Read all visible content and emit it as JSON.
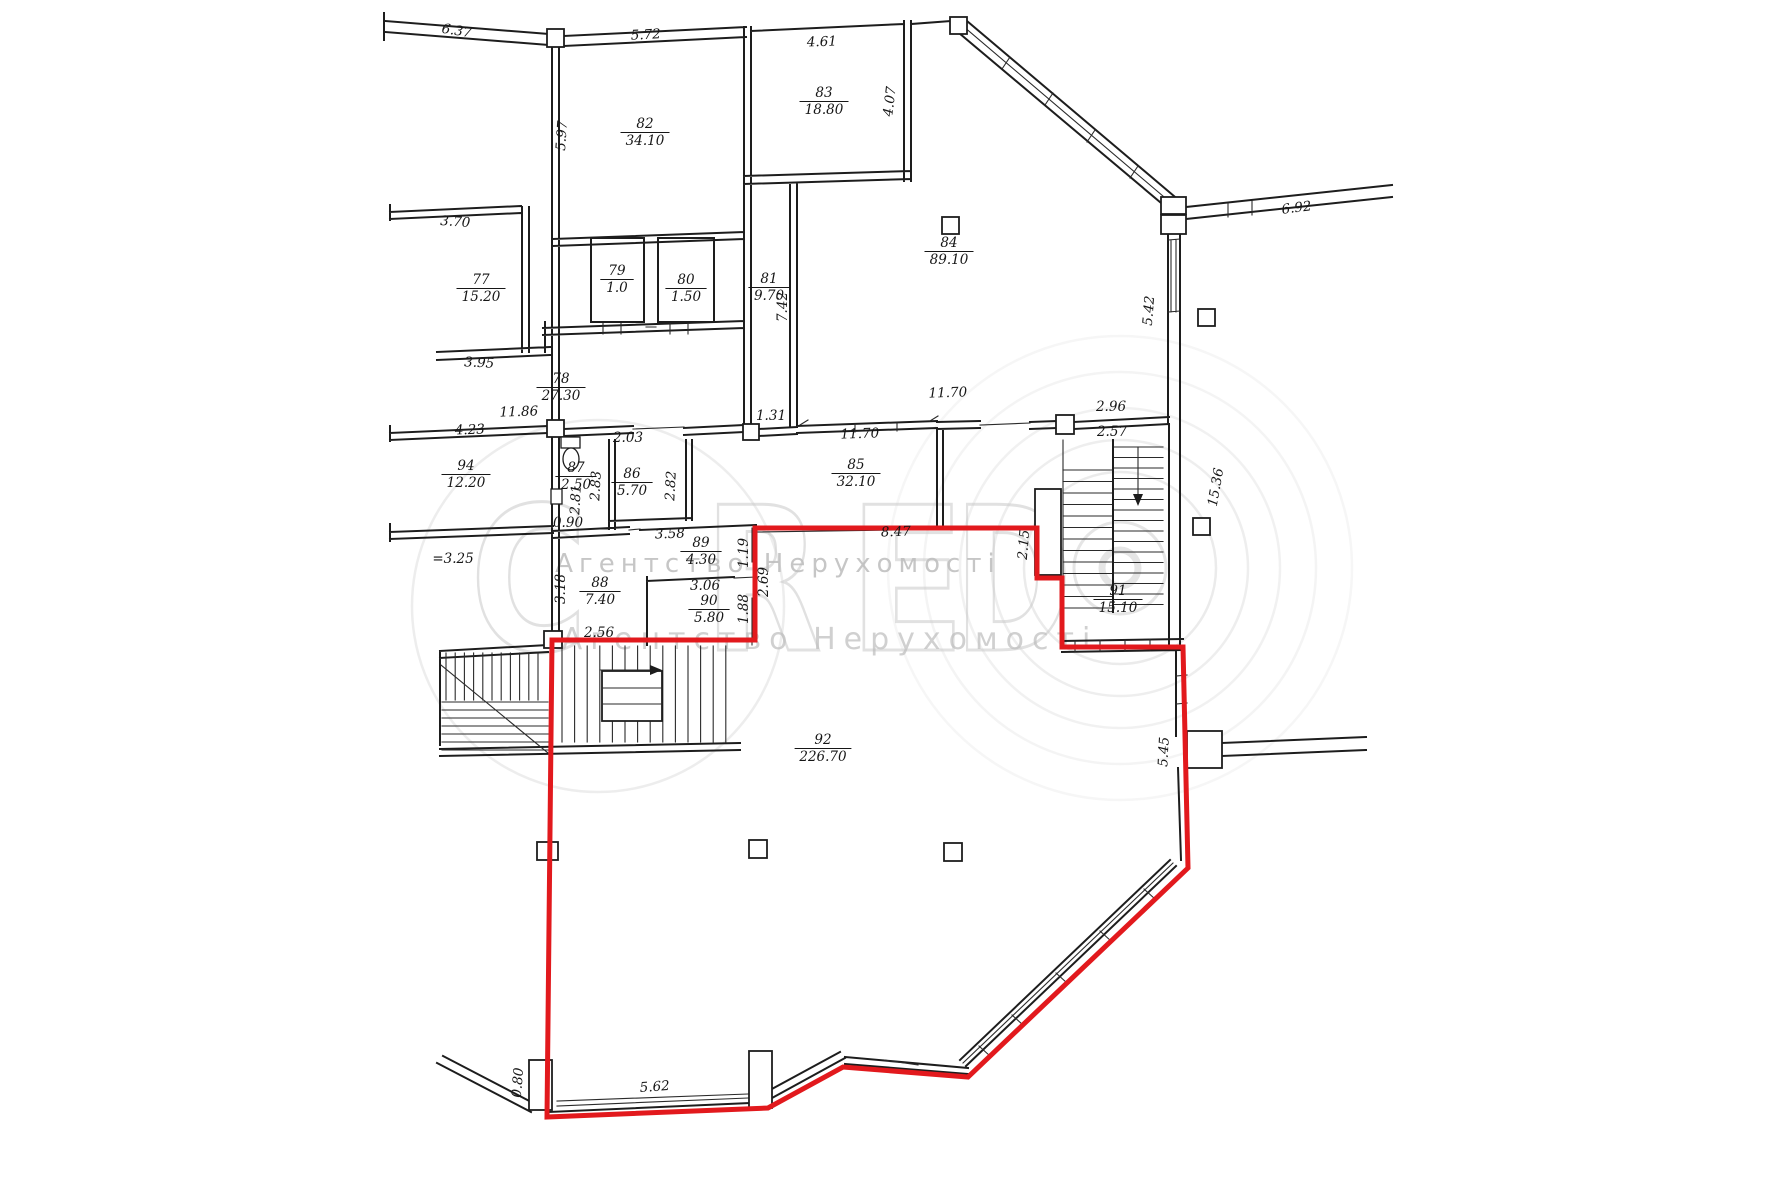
{
  "document": {
    "kind": "floor-plan-scan",
    "selected_unit_room": "92",
    "selected_unit_area": "226.70"
  },
  "colors": {
    "outline_red": "#e2191d",
    "wall_black": "#1d1d1d",
    "watermark_gray": "#c9c9c9",
    "paper": "#ffffff"
  },
  "watermark": {
    "brand": "CREDO",
    "letters": [
      {
        "ch": "C",
        "x": 470
      },
      {
        "ch": "R",
        "x": 704
      },
      {
        "ch": "E",
        "x": 848
      },
      {
        "ch": "D",
        "x": 954
      }
    ],
    "tagline1": "Агентство Нерухомості",
    "tagline2": "Агентство Нерухомості"
  },
  "rooms": [
    {
      "n": "77",
      "a": "15.20",
      "x": 481,
      "y": 284
    },
    {
      "n": "78",
      "a": "27.30",
      "x": 561,
      "y": 383
    },
    {
      "n": "79",
      "a": "1.0",
      "x": 617,
      "y": 275
    },
    {
      "n": "80",
      "a": "1.50",
      "x": 686,
      "y": 284
    },
    {
      "n": "81",
      "a": "9.70",
      "x": 769,
      "y": 283
    },
    {
      "n": "82",
      "a": "34.10",
      "x": 645,
      "y": 128
    },
    {
      "n": "83",
      "a": "18.80",
      "x": 824,
      "y": 97
    },
    {
      "n": "84",
      "a": "89.10",
      "x": 949,
      "y": 247
    },
    {
      "n": "85",
      "a": "32.10",
      "x": 856,
      "y": 469
    },
    {
      "n": "86",
      "a": "5.70",
      "x": 632,
      "y": 478
    },
    {
      "n": "87",
      "a": "2.50",
      "x": 576,
      "y": 472
    },
    {
      "n": "88",
      "a": "7.40",
      "x": 600,
      "y": 587
    },
    {
      "n": "89",
      "a": "4.30",
      "x": 701,
      "y": 547
    },
    {
      "n": "90",
      "a": "5.80",
      "x": 709,
      "y": 605
    },
    {
      "n": "91",
      "a": "15.10",
      "x": 1118,
      "y": 595
    },
    {
      "n": "92",
      "a": "226.70",
      "x": 823,
      "y": 744
    },
    {
      "n": "94",
      "a": "12.20",
      "x": 466,
      "y": 470
    }
  ],
  "dims": [
    {
      "t": "6.37",
      "x": 456,
      "y": 35,
      "r": 9
    },
    {
      "t": "5.72",
      "x": 646,
      "y": 39,
      "r": -3
    },
    {
      "t": "4.61",
      "x": 822,
      "y": 46,
      "r": -2
    },
    {
      "t": "5.97",
      "x": 566,
      "y": 136,
      "r": -86
    },
    {
      "t": "4.07",
      "x": 894,
      "y": 102,
      "r": -83
    },
    {
      "t": "3.70",
      "x": 455,
      "y": 226,
      "r": 4
    },
    {
      "t": "7.42",
      "x": 787,
      "y": 307,
      "r": -90
    },
    {
      "t": "6.92",
      "x": 1297,
      "y": 212,
      "r": -7
    },
    {
      "t": "5.42",
      "x": 1153,
      "y": 311,
      "r": -85
    },
    {
      "t": "3.95",
      "x": 479,
      "y": 367,
      "r": 3
    },
    {
      "t": "11.86",
      "x": 519,
      "y": 416,
      "r": -2
    },
    {
      "t": "4.23",
      "x": 470,
      "y": 434,
      "r": -2
    },
    {
      "t": "2.03",
      "x": 628,
      "y": 442,
      "r": 0
    },
    {
      "t": "1.31",
      "x": 771,
      "y": 420,
      "r": 0
    },
    {
      "t": "11.70",
      "x": 948,
      "y": 397,
      "r": -2
    },
    {
      "t": "11.70",
      "x": 860,
      "y": 438,
      "r": -2
    },
    {
      "t": "2.96",
      "x": 1111,
      "y": 411,
      "r": 0
    },
    {
      "t": "2.57",
      "x": 1112,
      "y": 436,
      "r": 0
    },
    {
      "t": "15.36",
      "x": 1220,
      "y": 488,
      "r": -80
    },
    {
      "t": "2.83",
      "x": 600,
      "y": 486,
      "r": -87
    },
    {
      "t": "2.82",
      "x": 675,
      "y": 486,
      "r": -87
    },
    {
      "t": "2.81",
      "x": 580,
      "y": 500,
      "r": -87
    },
    {
      "t": "0.90",
      "x": 568,
      "y": 527,
      "r": 0
    },
    {
      "t": "3.58",
      "x": 670,
      "y": 538,
      "r": -2
    },
    {
      "t": "1.19",
      "x": 748,
      "y": 553,
      "r": -90
    },
    {
      "t": "8.47",
      "x": 896,
      "y": 536,
      "r": -2
    },
    {
      "t": "2.15",
      "x": 1028,
      "y": 545,
      "r": -85
    },
    {
      "t": "2.69",
      "x": 768,
      "y": 582,
      "r": -90
    },
    {
      "t": "3.06",
      "x": 705,
      "y": 590,
      "r": 0
    },
    {
      "t": "1.88",
      "x": 748,
      "y": 609,
      "r": -90
    },
    {
      "t": "3.18",
      "x": 565,
      "y": 589,
      "r": -90
    },
    {
      "t": "2.56",
      "x": 599,
      "y": 637,
      "r": 0
    },
    {
      "t": "5.45",
      "x": 1168,
      "y": 752,
      "r": -87
    },
    {
      "t": "5.62",
      "x": 655,
      "y": 1091,
      "r": -4
    },
    {
      "t": "0.80",
      "x": 522,
      "y": 1083,
      "r": -85
    },
    {
      "t": "=3.25",
      "x": 453,
      "y": 563,
      "r": 0
    }
  ]
}
